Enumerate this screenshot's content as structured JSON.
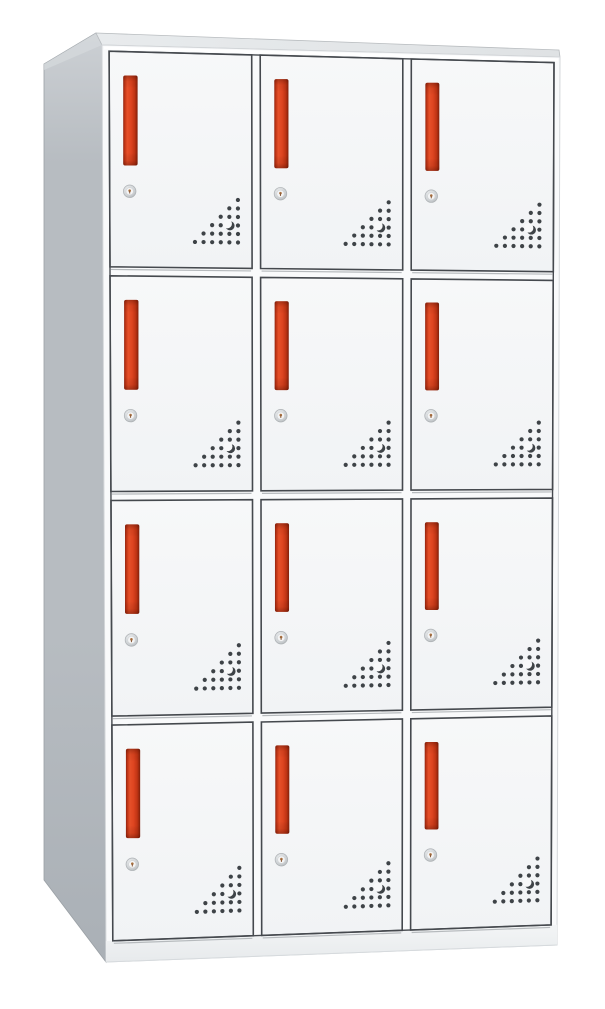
{
  "scene": {
    "description": "Product photo of a tall 12-compartment metal locker cabinet shown in three-quarter view. Four rows by three columns of white doors, each door with a vertical red recessed handle, a round keyhole lock below the handle, and a triangular pattern of ventilation holes with a crescent cutout in the lower-right corner.",
    "background_color": "#ffffff"
  },
  "cabinet": {
    "grid": {
      "rows": 4,
      "columns": 3,
      "total_doors": 12
    },
    "vent": {
      "rows": 6,
      "crescent_row": 3,
      "crescent_col": 4
    },
    "component_names": [
      "locker-door",
      "door-handle",
      "keyhole-lock",
      "vent-holes",
      "crescent-cutout",
      "side-panel",
      "top-surface",
      "base-plinth"
    ],
    "colors": {
      "background": "#ffffff",
      "side_panel_top": "#ccd0d4",
      "side_panel": "#b7bcc1",
      "side_panel_bottom": "#aab0b6",
      "side_bevel": "#d6dadd",
      "top_surface": "#e8ebed",
      "top_surface_dark": "#dfe2e4",
      "front_frame": "#f9fafb",
      "front_edge": "#d3d6d9",
      "door_face_light": "#f7f8f9",
      "door_face": "#f1f3f5",
      "outline": "#45494e",
      "seam_shadow": "#b6babd",
      "shine": "#ffffff",
      "handle_dark_edge": "#8f2310",
      "handle_mid": "#bf3414",
      "handle_bright": "#e65029",
      "handle_main": "#dd4420",
      "handle_deep": "#801f0a",
      "vent_dot": "#3e4347",
      "lock_ring": "#c9cdd0",
      "lock_ring_edge": "#aeb2b5",
      "lock_face": "#f4f5f6",
      "lock_keyhole": "#a9703f",
      "plinth_top": "#f3f5f6",
      "plinth_bottom": "#e7eaec",
      "plinth_edge": "#d6dadd"
    }
  }
}
